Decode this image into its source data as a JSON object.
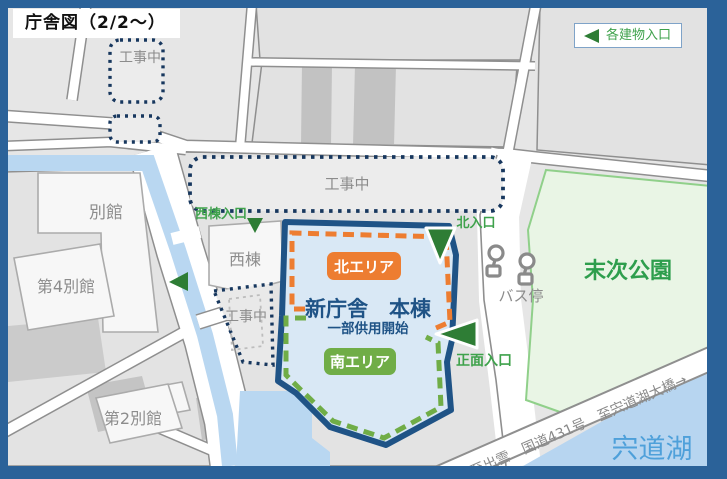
{
  "title": "庁舎図（2/2～）",
  "legend": {
    "entrance_label": "各建物入口"
  },
  "map": {
    "construction": "工事中",
    "buildings": {
      "annex": "別館",
      "annex4": "第4別館",
      "annex2": "第2別館",
      "west_wing": "西棟"
    },
    "main_building": {
      "name": "新庁舎　本棟",
      "status": "一部供用開始",
      "north_area": "北エリア",
      "south_area": "南エリア"
    },
    "entrances": {
      "west": "西棟入口",
      "north": "北入口",
      "front": "正面入口"
    },
    "bus_stop": "バス停",
    "park": "末次公園",
    "lake": "宍道湖",
    "road": "←至出雲　国道431号　至宍道湖大橋→",
    "colors": {
      "frame": "#2B6299",
      "main_outline": "#1F5386",
      "main_fill": "#D9E8F5",
      "north_area": "#ED7D31",
      "south_area": "#70AD47",
      "entrance_green": "#2E7D35",
      "water": "#B9D7F1",
      "park_fill": "#E9F5E5",
      "construction_dot": "#17375E"
    }
  }
}
